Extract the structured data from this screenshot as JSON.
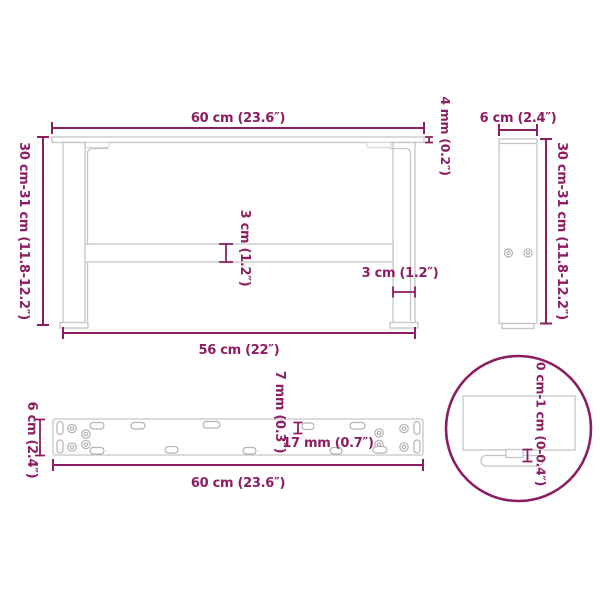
{
  "accent_color": "#8C1D61",
  "line_color": "#c5c5c5",
  "line_light_color": "#d9d9d9",
  "hole_color": "#b2b2b2",
  "views": {
    "front": {
      "width": "60 cm (23.6″)",
      "plate_thickness": "4 mm (0.2″)",
      "height": "30 cm-31 cm (11.8-12.2″)",
      "crossbar_thickness": "3 cm (1.2″)",
      "leg_width": "3 cm (1.2″)",
      "leg_span": "56 cm (22″)"
    },
    "side": {
      "depth": "6 cm (2.4″)",
      "height": "30 cm-31 cm (11.8-12.2″)"
    },
    "plate": {
      "width": "6 cm (2.4″)",
      "length": "60 cm (23.6″)",
      "hole_width": "7 mm (0.3″)",
      "hole_length": "17 mm (0.7″)"
    },
    "detail": {
      "adjustable_range": "0 cm-1 cm (0-0.4″)"
    }
  }
}
